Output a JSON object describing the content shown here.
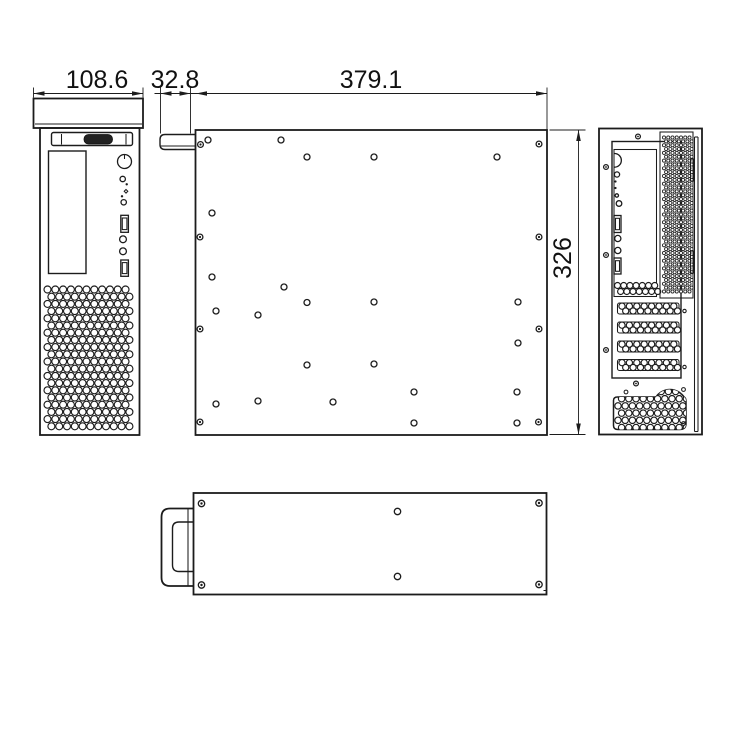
{
  "dimensions": {
    "front_width": "108.6",
    "handle_depth": "32.8",
    "body_length": "379.1",
    "body_height": "326"
  },
  "side_panel": {
    "screw_holes": [
      [
        200.5,
        144.5
      ],
      [
        539,
        144
      ],
      [
        200,
        237
      ],
      [
        539,
        237
      ],
      [
        200,
        329
      ],
      [
        539,
        329
      ],
      [
        200,
        422
      ],
      [
        538.5,
        422
      ]
    ],
    "open_holes": [
      [
        208,
        140
      ],
      [
        281,
        140
      ],
      [
        307,
        157
      ],
      [
        374,
        157
      ],
      [
        497,
        157
      ],
      [
        212,
        213
      ],
      [
        212,
        277
      ],
      [
        284,
        287
      ],
      [
        307,
        302.5
      ],
      [
        374,
        302
      ],
      [
        518,
        302
      ],
      [
        216,
        311
      ],
      [
        258,
        315
      ],
      [
        518,
        343
      ],
      [
        307,
        365
      ],
      [
        374,
        364
      ],
      [
        216,
        404
      ],
      [
        258,
        401
      ],
      [
        333,
        402
      ],
      [
        414,
        392
      ],
      [
        517,
        392
      ],
      [
        414,
        423
      ],
      [
        517,
        423
      ]
    ]
  },
  "top_view": {
    "corner_screws": [
      [
        201.5,
        503.5
      ],
      [
        539,
        503
      ],
      [
        201.5,
        585
      ],
      [
        539,
        584.5
      ]
    ],
    "center_holes": [
      [
        397.5,
        511.5
      ],
      [
        397.5,
        576.5
      ]
    ]
  },
  "rear_view": {
    "frame_screws": [
      [
        606,
        167
      ],
      [
        606,
        255
      ],
      [
        606,
        350
      ],
      [
        638,
        136.5
      ],
      [
        636,
        383.5
      ]
    ],
    "slot_screws": [
      [
        684.5,
        311
      ],
      [
        684.5,
        367
      ]
    ],
    "psu_screws": [
      [
        626,
        392
      ],
      [
        683.5,
        389.5
      ],
      [
        683.5,
        423.5
      ]
    ]
  },
  "vents": {
    "front": {
      "x": 47.5,
      "y": 289.5,
      "cols": 11,
      "rows": 20,
      "dx": 7.8,
      "dy": 7.2,
      "stagger": 3.9,
      "r": 3.5,
      "cls": "vh"
    },
    "rear_main": {
      "x": 664,
      "y": 137.5,
      "cols": 7,
      "rows": 41,
      "dx": 4.25,
      "dy": 3.85,
      "stagger": 2.1,
      "r": 1.55,
      "cls": "vh2"
    },
    "rear_io": {
      "x": 617.5,
      "y": 285.5,
      "cols": 7,
      "rows": 2,
      "dx": 6.2,
      "dy": 6,
      "stagger": 3.1,
      "r": 3.0,
      "cls": "vh"
    },
    "psu": {
      "x": 618,
      "y": 391.5,
      "cols": 10,
      "rows": 6,
      "dx": 7.2,
      "dy": 7.2,
      "stagger": 3.6,
      "r": 3.2,
      "cls": "vh"
    },
    "slots": {
      "x": 622,
      "cols": 8,
      "dx": 7.4,
      "r": 3.1,
      "row_offsets": [
        3.2,
        8.0
      ],
      "stagger": 3.7,
      "slot_x": 617.5,
      "slot_w": 61.5,
      "slot_h": 11,
      "slot_y": [
        303,
        322,
        341,
        359.5
      ]
    }
  }
}
